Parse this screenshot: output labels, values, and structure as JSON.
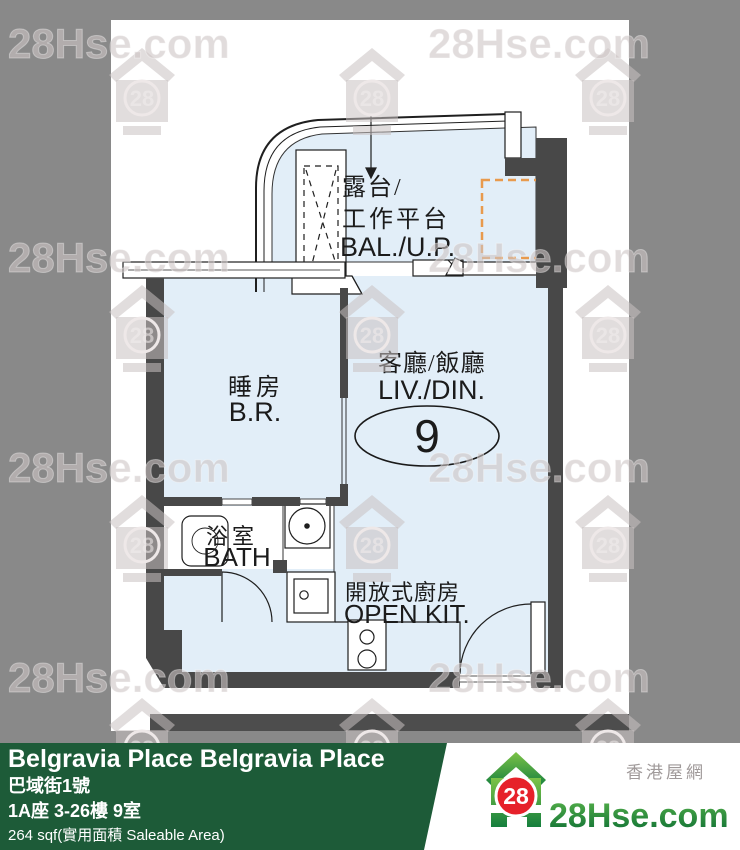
{
  "page": {
    "background": "#898989"
  },
  "watermark": {
    "text": "28Hse.com",
    "badge": "28"
  },
  "floorplan": {
    "unit_number": "9",
    "labels": {
      "balcony_line1": "露台/",
      "balcony_line2": "工作平台",
      "balcony_en": "BAL./U.P.",
      "bedroom": "睡房",
      "bedroom_en": "B.R.",
      "living": "客廳/飯廳",
      "living_en": "LIV./DIN.",
      "bath": "浴室",
      "bath_en": "BATH",
      "kitchen": "開放式廚房",
      "kitchen_en": "OPEN KIT."
    },
    "colors": {
      "room_fill": "#e2eef8",
      "wall": "#484848",
      "ac_outline": "#e89a4d",
      "line": "#1f1f1f"
    }
  },
  "banner": {
    "title": "Belgravia Place Belgravia Place",
    "address": "巴域街1號",
    "unit": "1A座 3-26樓 9室",
    "area": "264 sqf(實用面積 Saleable Area)",
    "background": "#1d5b38"
  },
  "logo": {
    "badge": "28",
    "site": "28Hse.com",
    "tagline": "香港屋網",
    "green_dark": "#0b6c34",
    "green_light": "#7cc347",
    "red": "#e6212a"
  }
}
